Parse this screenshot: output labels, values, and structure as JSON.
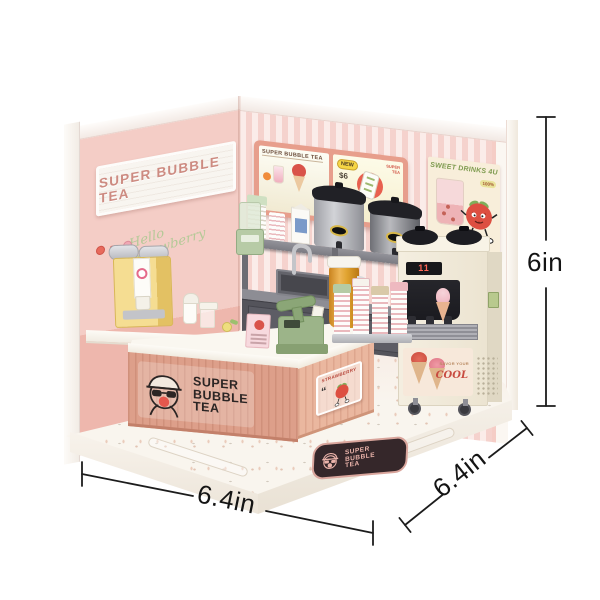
{
  "image": {
    "alt": "Miniature DIY bubble tea shop corner kit with printed size annotations"
  },
  "left_wall": {
    "sign": "SUPER BUBBLE TEA",
    "script_line1": "Hello",
    "script_line2": "Strawberry"
  },
  "menu_board": {
    "title": "SUPER BUBBLE TEA",
    "new_badge": "NEW",
    "price": "$6",
    "brand_line1": "SUPER",
    "brand_line2": "TEA"
  },
  "poster": {
    "title": "SWEET DRINKS 4U",
    "badge": "100%"
  },
  "counter": {
    "logo_lines": [
      "SUPER",
      "BUBBLE",
      "TEA"
    ],
    "plaque_title": "STRAWBERRY",
    "plaque_quote": "“"
  },
  "ice_cream_machine": {
    "display": "11",
    "sticker_sub": "SAVOR YOUR",
    "sticker_main": "COOL"
  },
  "floor_mat": {
    "lines": [
      "SUPER",
      "BUBBLE",
      "TEA"
    ]
  },
  "dimensions": {
    "height": "6in",
    "width": "6.4in",
    "depth": "6.4in"
  },
  "colors": {
    "wall_pink": "#f2c8c1",
    "stripe_pink": "#f5d2cd",
    "menu_frame_coral": "#e79e8c",
    "counter_salmon": "#dd9f8a",
    "accent_red": "#d94f43",
    "sage_green": "#9cb489",
    "machine_cream": "#f3edde",
    "mat_brown": "#35272a",
    "dimension_ink": "#141414"
  }
}
